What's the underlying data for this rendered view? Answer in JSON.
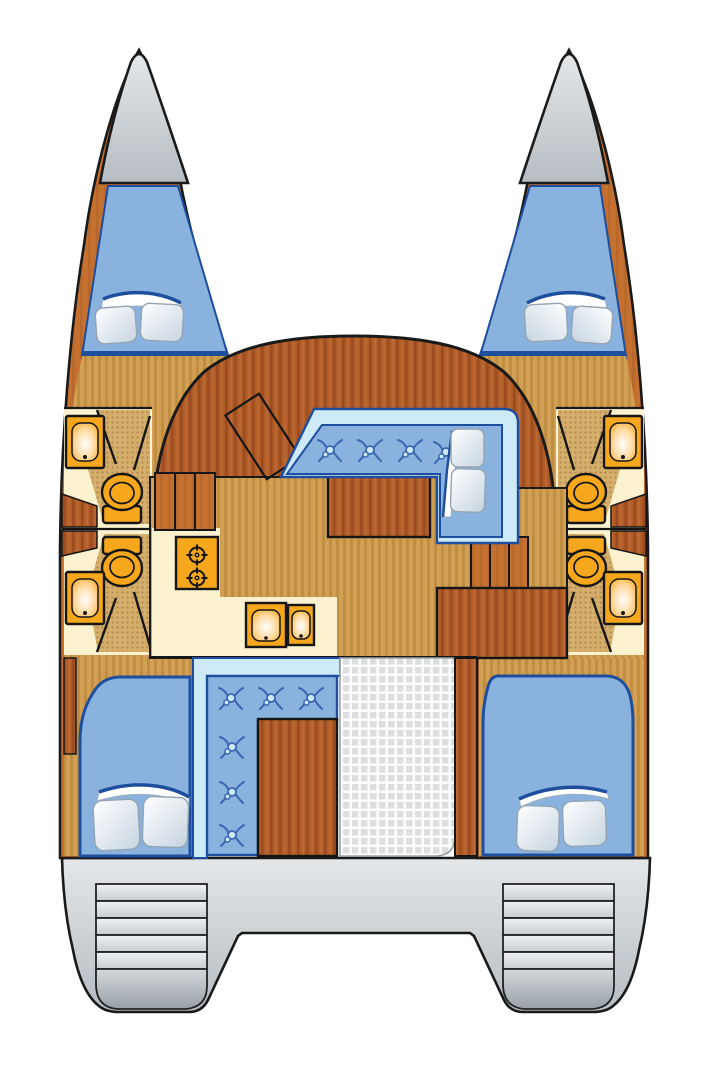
{
  "image": {
    "width": 711,
    "height": 1080,
    "background": "#ffffff",
    "title": "Catamaran deck floor plan (top view)"
  },
  "palette": {
    "outline": "#1a1a1a",
    "hull": "#c5702f",
    "hull_stripe": "rgba(60,25,5,0.10)",
    "furn": "#b25c28",
    "furn_stripe": "rgba(70,25,5,0.22)",
    "furn_light": "rgba(255,190,140,0.12)",
    "floor": "#d2a055",
    "floor_stripe": "#c08e40",
    "shower": "#d6ae6b",
    "shower_dot": "#a9854a",
    "cream": "#fdf2cf",
    "uph": "#8ab2de",
    "uph_light": "#cfeaf7",
    "uph_dark": "#1d4f9e",
    "tuft": "#3a67b0",
    "fixture": "#f6a71b",
    "gray_hi": "#e4e7e9",
    "gray_lo": "#b6bdc2",
    "step_hi": "#f0f2f4",
    "step_lo": "#c6ccd1",
    "scoop_hi": "#d3d8db",
    "scoop_lo": "#99a1a7",
    "grid_sq": "#dcdee0",
    "pillow_hi": "#ffffff",
    "pillow_lo": "#c6d4e0",
    "sink_mid": "#ffd9a0"
  },
  "vessel": {
    "type": "catamaran",
    "view": "deck plan, bows up",
    "hulls": 2,
    "cabins": 4,
    "heads": 4
  },
  "counts": {
    "double_berths": 4,
    "pillows_total": 10,
    "toilets": 4,
    "bathroom_sinks": 4,
    "galley_burners": 2,
    "galley_sink_basins": 2,
    "saloon_sofa_buttons": 4,
    "cockpit_bench_buttons": 6,
    "companionway_steps_port": 3,
    "companionway_steps_starboard": 3,
    "stern_steps_per_side": 5
  },
  "components": [
    "port-bow",
    "starboard-bow",
    "port-forward-berth",
    "starboard-forward-berth",
    "port-forward-head",
    "port-aft-head",
    "starboard-forward-head",
    "starboard-aft-head",
    "saloon",
    "nav-table",
    "saloon-sofa",
    "saloon-table",
    "galley-stove",
    "galley-sink",
    "cockpit-bench",
    "cockpit-table",
    "cockpit-floor",
    "port-aft-berth",
    "starboard-aft-berth",
    "stern-platform",
    "transom-steps"
  ]
}
